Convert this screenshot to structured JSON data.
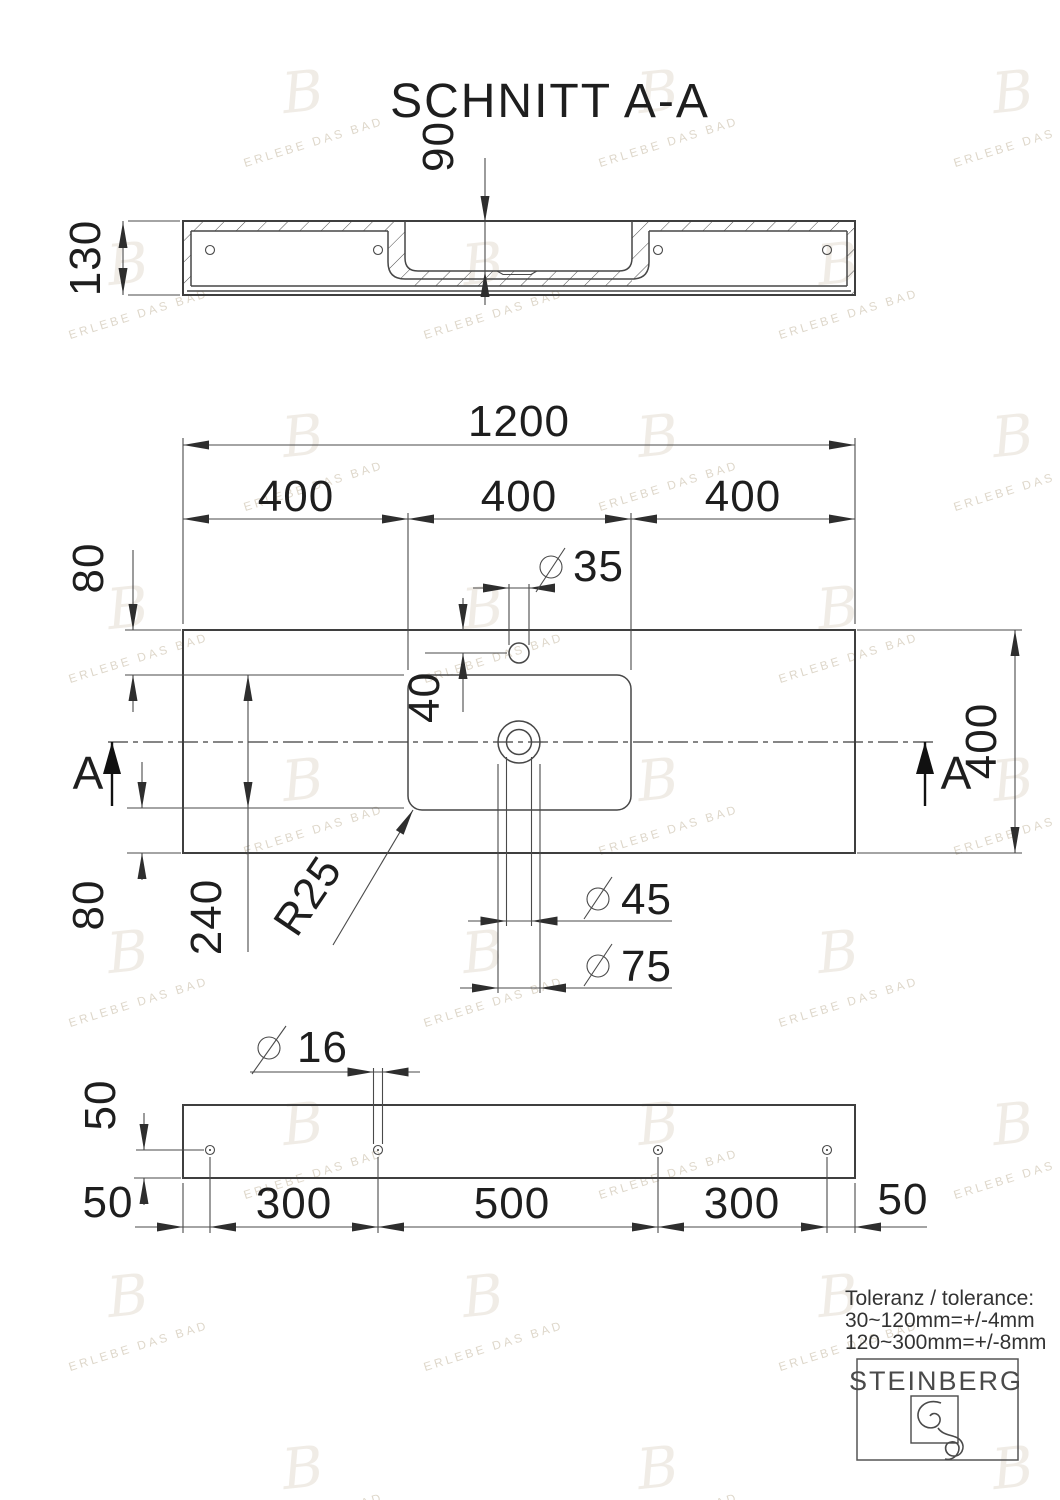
{
  "title": "SCHNITT A-A",
  "watermark": {
    "text": "ERLEBE DAS BAD",
    "glyph": "B"
  },
  "symbols": {
    "diameter": "⌀"
  },
  "section_view": {
    "height": "130",
    "basin_depth": "90"
  },
  "plan_view": {
    "total_width": "1200",
    "width_segments": [
      "400",
      "400",
      "400"
    ],
    "top_offset": "80",
    "bottom_offset": "80",
    "recess_depth": "240",
    "total_depth": "400",
    "faucet_hole_dia": "35",
    "faucet_offset": "40",
    "drain_dia": "45",
    "drain_outer_dia": "75",
    "corner_radius": "R25",
    "section_label_left": "A",
    "section_label_right": "A"
  },
  "bottom_view": {
    "hole_dia": "16",
    "hole_edge_offset": "50",
    "margin_left": "50",
    "hole_spacings": [
      "300",
      "500",
      "300"
    ],
    "margin_right": "50"
  },
  "tolerance": {
    "line1": "Toleranz / tolerance:",
    "line2": "30~120mm=+/-4mm",
    "line3": "120~300mm=+/-8mm"
  },
  "brand": {
    "name": "STEINBERG"
  }
}
